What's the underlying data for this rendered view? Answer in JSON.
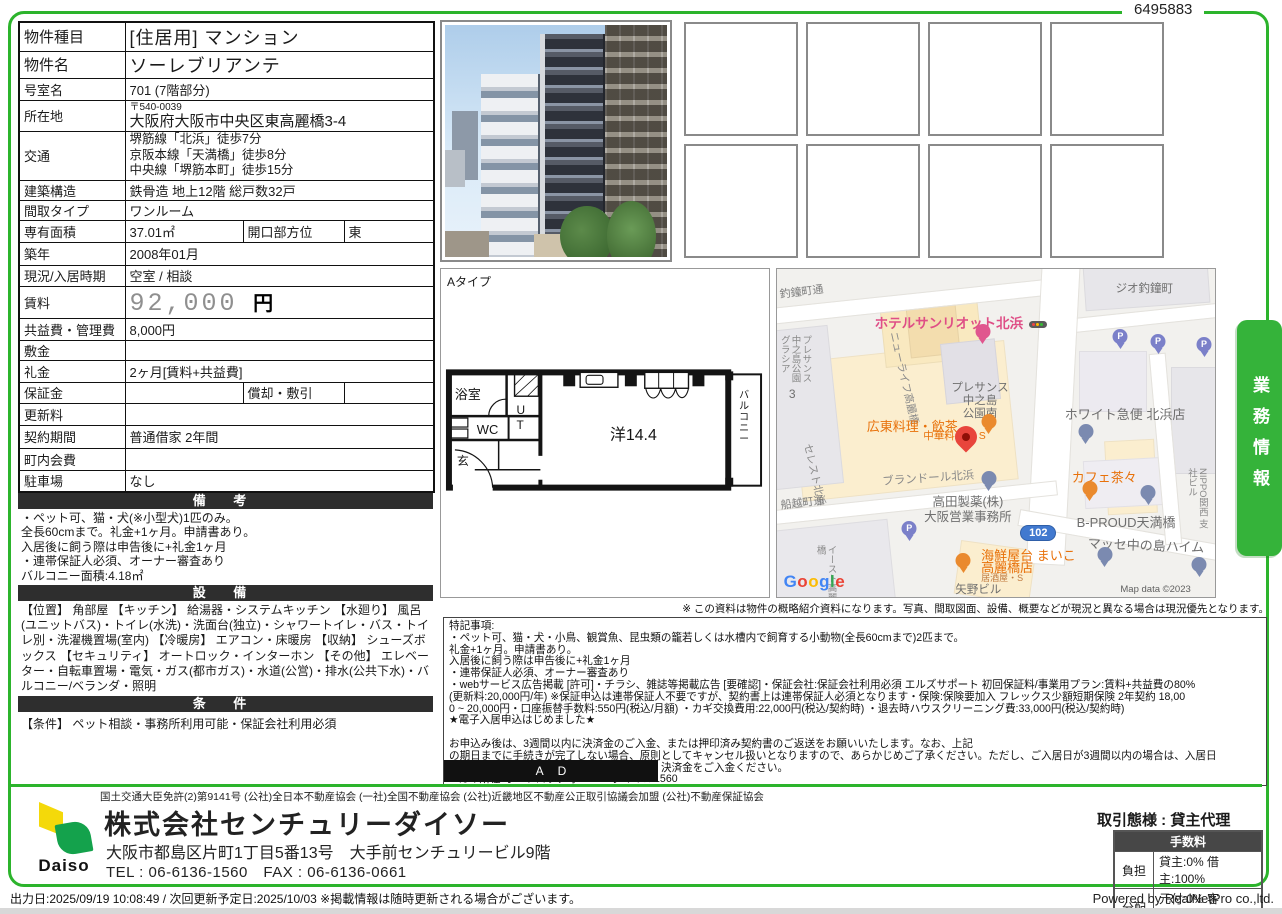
{
  "page": {
    "doc_number": "6495883",
    "disclaimer": "※ この資料は物件の概略紹介資料になります。写真、間取図面、設備、概要などが現況と異なる場合は現況優先となります。",
    "output_line": "出力日:2025/09/19 10:08:49 / 次回更新予定日:2025/10/03 ※掲載情報は随時更新される場合がございます。",
    "powered_by": "Powered by RealNetPro co.,ltd.",
    "side_tab": "業務情報"
  },
  "property_table": {
    "rows": [
      {
        "label": "物件種目",
        "value": "[住居用] マンション"
      },
      {
        "label": "物件名",
        "value": "ソーレブリアンテ"
      },
      {
        "label": "号室名",
        "value": "701 (7階部分)"
      },
      {
        "label": "所在地",
        "postal": "〒540-0039",
        "value": "大阪府大阪市中央区東高麗橋3-4"
      },
      {
        "label": "交通",
        "lines": [
          "堺筋線「北浜」徒歩7分",
          "京阪本線「天満橋」徒歩8分",
          "中央線「堺筋本町」徒歩15分"
        ]
      },
      {
        "label": "建築構造",
        "value": "鉄骨造 地上12階 総戸数32戸"
      },
      {
        "label": "間取タイプ",
        "value": "ワンルーム"
      },
      {
        "label": "専有面積",
        "value": "37.01㎡",
        "label2": "開口部方位",
        "value2": "東"
      },
      {
        "label": "築年",
        "value": "2008年01月"
      },
      {
        "label": "現況/入居時期",
        "value": "空室 / 相談"
      },
      {
        "label": "賃料",
        "value": "92,000",
        "unit": "円"
      },
      {
        "label": "共益費・管理費",
        "value": "8,000円"
      },
      {
        "label": "敷金",
        "value": ""
      },
      {
        "label": "礼金",
        "value": "2ヶ月[賃料+共益費]"
      },
      {
        "label": "保証金",
        "value": "",
        "label2": "償却・敷引",
        "value2": ""
      },
      {
        "label": "更新料",
        "value": ""
      },
      {
        "label": "契約期間",
        "value": "普通借家 2年間"
      },
      {
        "label": "町内会費",
        "value": ""
      },
      {
        "label": "駐車場",
        "value": "なし"
      }
    ]
  },
  "sections": {
    "remarks": {
      "title": "備 考",
      "lines": [
        "・ペット可、猫・犬(※小型犬)1匹のみ。",
        "全長60cmまで。礼金+1ヶ月。申請書あり。",
        "入居後に飼う際は申告後に+礼金1ヶ月",
        "・連帯保証人必須、オーナー審査あり",
        "バルコニー面積:4.18㎡"
      ]
    },
    "equipment": {
      "title": "設 備",
      "text": "【位置】 角部屋 【キッチン】 給湯器・システムキッチン 【水廻り】 風呂(ユニットバス)・トイレ(水洗)・洗面台(独立)・シャワートイレ・バス・トイレ別・洗濯機置場(室内) 【冷暖房】 エアコン・床暖房 【収納】 シューズボックス 【セキュリティ】 オートロック・インターホン 【その他】 エレベーター・自転車置場・電気・ガス(都市ガス)・水道(公営)・排水(公共下水)・バルコニー/ベランダ・照明"
    },
    "conditions": {
      "title": "条 件",
      "text": "【条件】 ペット相談・事務所利用可能・保証会社利用必須"
    }
  },
  "floor_plan": {
    "type_label": "Aタイプ",
    "rooms": {
      "bath": "浴室",
      "wc": "WC",
      "ut": "UT",
      "entrance": "玄",
      "main": "洋14.4",
      "balcony": "バルコニー"
    }
  },
  "map": {
    "route_badge": "102",
    "map_data": "Map data ©2023",
    "google_letters": [
      {
        "ch": "G",
        "c": "#4285F4"
      },
      {
        "ch": "o",
        "c": "#EA4335"
      },
      {
        "ch": "o",
        "c": "#FBBC05"
      },
      {
        "ch": "g",
        "c": "#4285F4"
      },
      {
        "ch": "l",
        "c": "#34A853"
      },
      {
        "ch": "e",
        "c": "#EA4335"
      }
    ],
    "labels": [
      {
        "text": "釣鐘町通",
        "x": 0.5,
        "y": 6,
        "size": 11,
        "color": "#7d7d7d",
        "rot": -7
      },
      {
        "text": "ジオ釣鐘町",
        "x": 77.3,
        "y": 4.2,
        "size": 11.5,
        "color": "#6f6f6f"
      },
      {
        "text": "ホテルサンリオット北浜",
        "x": 22.3,
        "y": 14.2,
        "size": 13.5,
        "color": "#df4e86",
        "bold": true
      },
      {
        "text": "プレサンス中之島公園グラシア",
        "x": 0.2,
        "y": 20,
        "size": 9.5,
        "color": "#8a8a8a",
        "vert": true,
        "h": 55
      },
      {
        "text": "3",
        "x": 2.7,
        "y": 36.4,
        "size": 12,
        "color": "#6f6f6f"
      },
      {
        "text": "ニューライフ高麗橋",
        "x": 27.7,
        "y": 18.8,
        "size": 10.5,
        "color": "#8a8a8a",
        "rot": 77
      },
      {
        "text": "セレスト北浜",
        "x": 8,
        "y": 53,
        "size": 10.5,
        "color": "#8a8a8a",
        "rot": 77
      },
      {
        "text": "プレサンス\n中之島\n公園南",
        "x": 39.8,
        "y": 34.5,
        "size": 11.5,
        "color": "#6f6f6f",
        "center": true
      },
      {
        "text": "広東料理・飲茶",
        "x": 20.5,
        "y": 46,
        "size": 13,
        "color": "#e8710a"
      },
      {
        "text": "中華料理 ・S",
        "x": 33.4,
        "y": 49.4,
        "size": 10.5,
        "color": "#e8710a"
      },
      {
        "text": "ホワイト急便 北浜店",
        "x": 65.7,
        "y": 42.4,
        "size": 13,
        "color": "#6f6f6f"
      },
      {
        "text": "ブランドール北浜",
        "x": 23.9,
        "y": 63,
        "size": 11.5,
        "color": "#8a8a8a",
        "rot": -4
      },
      {
        "text": "カフェ茶々",
        "x": 67.3,
        "y": 61.5,
        "size": 13,
        "color": "#e8710a"
      },
      {
        "text": "高田製薬(株)\n大阪営業事務所",
        "x": 33.6,
        "y": 69,
        "size": 12.5,
        "color": "#6f6f6f",
        "center": true
      },
      {
        "text": "B-PROUD天満橋",
        "x": 68.4,
        "y": 75.2,
        "size": 13,
        "color": "#6f6f6f"
      },
      {
        "text": "NIPPO関西\n支社ビル",
        "x": 93.2,
        "y": 60.6,
        "size": 9.5,
        "color": "#8a8a8a",
        "vert": true,
        "h": 62
      },
      {
        "text": "船越町通",
        "x": 0.7,
        "y": 70.3,
        "size": 11,
        "color": "#7d7d7d",
        "rot": -7
      },
      {
        "text": "マッセ中の島ハイム",
        "x": 70.9,
        "y": 81.8,
        "size": 13,
        "color": "#6f6f6f",
        "rot": 2
      },
      {
        "text": "海鮮屋台 まいこ",
        "x": 46.6,
        "y": 85.5,
        "size": 13,
        "color": "#e8710a"
      },
      {
        "text": "高麗橋店",
        "x": 46.6,
        "y": 89,
        "size": 13,
        "color": "#e8710a"
      },
      {
        "text": "居酒屋・S",
        "x": 46.6,
        "y": 92.7,
        "size": 9,
        "color": "#c07a3e"
      },
      {
        "text": "矢野ビル",
        "x": 40.7,
        "y": 96,
        "size": 11.5,
        "color": "#6f6f6f"
      },
      {
        "text": "イースト高麗橋",
        "x": 8.4,
        "y": 84,
        "size": 9.5,
        "color": "#8a8a8a",
        "vert": true,
        "h": 60
      },
      {
        "text": "Map data ©2023",
        "x": 78.4,
        "y": 96.2,
        "size": 9.5,
        "color": "#5f5f5f"
      }
    ],
    "pins": [
      {
        "type": "hotel",
        "x": 47,
        "y": 24
      },
      {
        "type": "traffic",
        "x": 59.5,
        "y": 18
      },
      {
        "type": "parking",
        "x": 78.4,
        "y": 25.5
      },
      {
        "type": "parking",
        "x": 87,
        "y": 27
      },
      {
        "type": "parking",
        "x": 97.5,
        "y": 28
      },
      {
        "type": "red",
        "x": 43.2,
        "y": 54.5
      },
      {
        "type": "restaurant",
        "x": 48.4,
        "y": 51.5
      },
      {
        "type": "poi",
        "x": 70.5,
        "y": 54.5
      },
      {
        "type": "poi",
        "x": 48.4,
        "y": 68.8
      },
      {
        "type": "cafe",
        "x": 71.4,
        "y": 71.8
      },
      {
        "type": "poi",
        "x": 84.8,
        "y": 73.3
      },
      {
        "type": "parking",
        "x": 30.2,
        "y": 84
      },
      {
        "type": "restaurant",
        "x": 42.5,
        "y": 94
      },
      {
        "type": "poi",
        "x": 74.8,
        "y": 92
      },
      {
        "type": "poi",
        "x": 96.4,
        "y": 95
      }
    ]
  },
  "photo_grid": {
    "count": 8
  },
  "special_notes": {
    "indent_line_index": 12,
    "lines": [
      "特記事項:",
      "・ペット可、猫・犬・小鳥、観賞魚、昆虫類の籠若しくは水槽内で飼育する小動物(全長60cmまで)2匹まで。",
      "礼金+1ヶ月。申請書あり。",
      "入居後に飼う際は申告後に+礼金1ヶ月",
      "・連帯保証人必須、オーナー審査あり",
      "・webサービス広告掲載 [許可]・チラシ、雑誌等掲載広告 [要確認]・保証会社:保証会社利用必須 エルズサポート 初回保証料/事業用プラン:賃料+共益費の80%",
      "(更新料:20,000円/年) ※保証申込は連帯保証人不要ですが、契約書上は連帯保証人必須となります・保険:保険要加入 フレックス少額短期保険 2年契約 18,00",
      "0 ~ 20,000円・口座振替手数料:550円(税込/月額) ・カギ交換費用:22,000円(税込/契約時) ・退去時ハウスクリーニング費:33,000円(税込/契約時)",
      "★電子入居申込はじめました★",
      "",
      "お申込み後は、3週間以内に決済金のご入金、または押印済み契約書のご返送をお願いいたします。なお、上記",
      "の期日までに手続きが完了しない場合、原則としてキャンセル扱いとなりますので、あらかじめご了承ください。ただし、ご入居日が3週間以内の場合は、入居日",
      "決済金をご入金ください。",
      "■ カギ所在:オートロック呼1234・ダイヤル1560"
    ],
    "ad_label": "AD"
  },
  "footer": {
    "license": "国土交通大臣免許(2)第9141号 (公社)全日本不動産協会 (一社)全国不動産協会 (公社)近畿地区不動産公正取引協議会加盟 (公社)不動産保証協会",
    "logo_text": "Daiso",
    "company": "株式会社センチュリーダイソー",
    "address": "大阪市都島区片町1丁目5番13号　大手前センチュリービル9階",
    "tel_fax": "TEL : 06-6136-1560　FAX : 06-6136-0661",
    "deal_type": "取引態様 : 貸主代理",
    "fee_table": {
      "title": "手数料",
      "rows": [
        {
          "label": "負担",
          "value": "貸主:0% 借主:100%"
        },
        {
          "label": "分配",
          "value": "元付:0% 客付:100%"
        }
      ]
    }
  }
}
